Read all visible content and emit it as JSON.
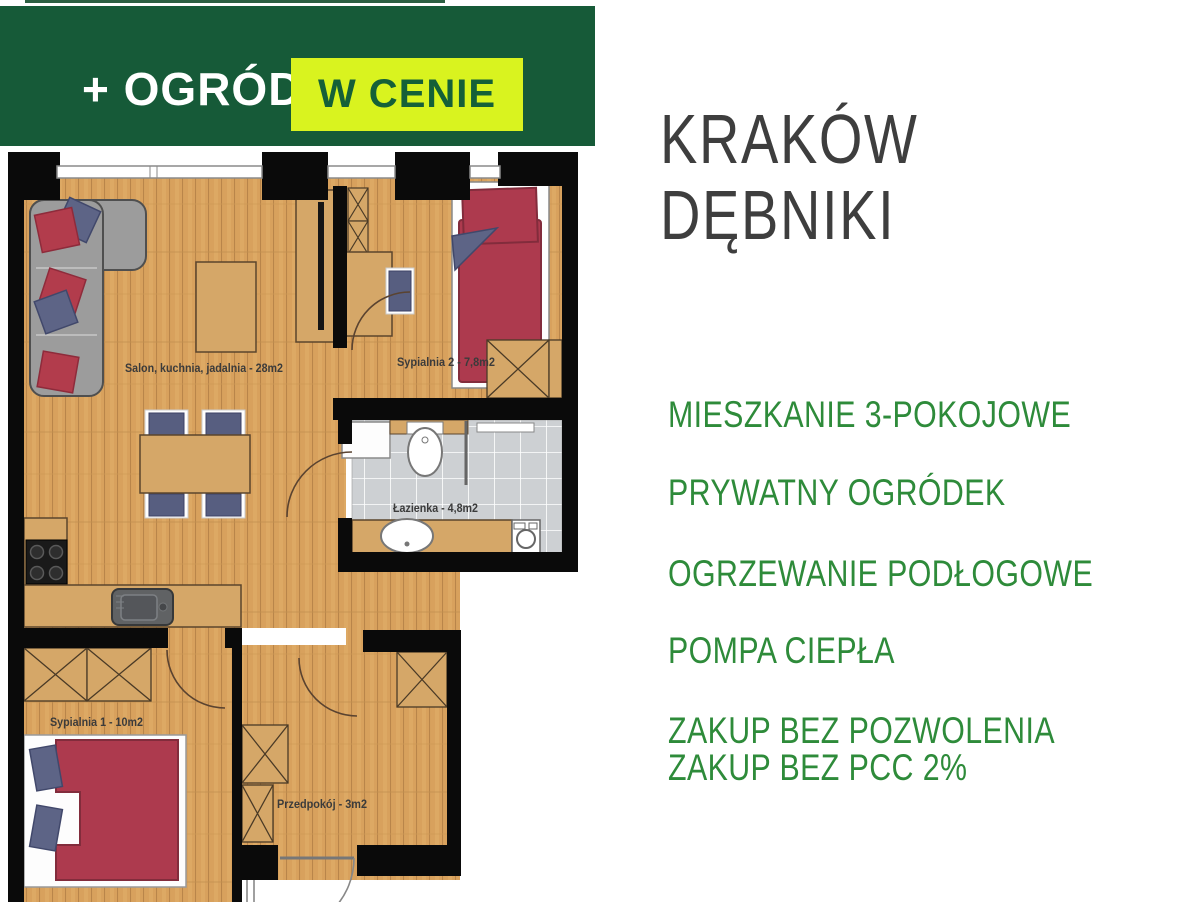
{
  "banner": {
    "left_text": "+ OGRÓD",
    "highlight_text": "W CENIE"
  },
  "location": {
    "city": "KRAKÓW",
    "district": "DĘBNIKI"
  },
  "features": [
    "MIESZKANIE 3-POKOJOWE",
    "PRYWATNY OGRÓDEK",
    "OGRZEWANIE PODŁOGOWE",
    "POMPA CIEPŁA",
    "ZAKUP BEZ POZWOLENIA",
    "ZAKUP BEZ PCC 2%"
  ],
  "floorplan": {
    "rooms": [
      {
        "label": "Salon, kuchnia, jadalnia - 28m2"
      },
      {
        "label": "Sypialnia 2 - 7,8m2"
      },
      {
        "label": "Łazienka - 4,8m2"
      },
      {
        "label": "Sypialnia 1 - 10m2"
      },
      {
        "label": "Przedpokój - 3m2"
      }
    ]
  },
  "colors": {
    "banner_green": "#165a38",
    "lime": "#d9f31f",
    "lime_text_green": "#156038",
    "feature_green": "#2e8b3a",
    "heading_gray": "#3e3e3e",
    "wall_black": "#0a0a0a",
    "wood_tan": "#d8a15d",
    "bed_red": "#ad3a4e",
    "pillow_blue": "#5d6486"
  }
}
